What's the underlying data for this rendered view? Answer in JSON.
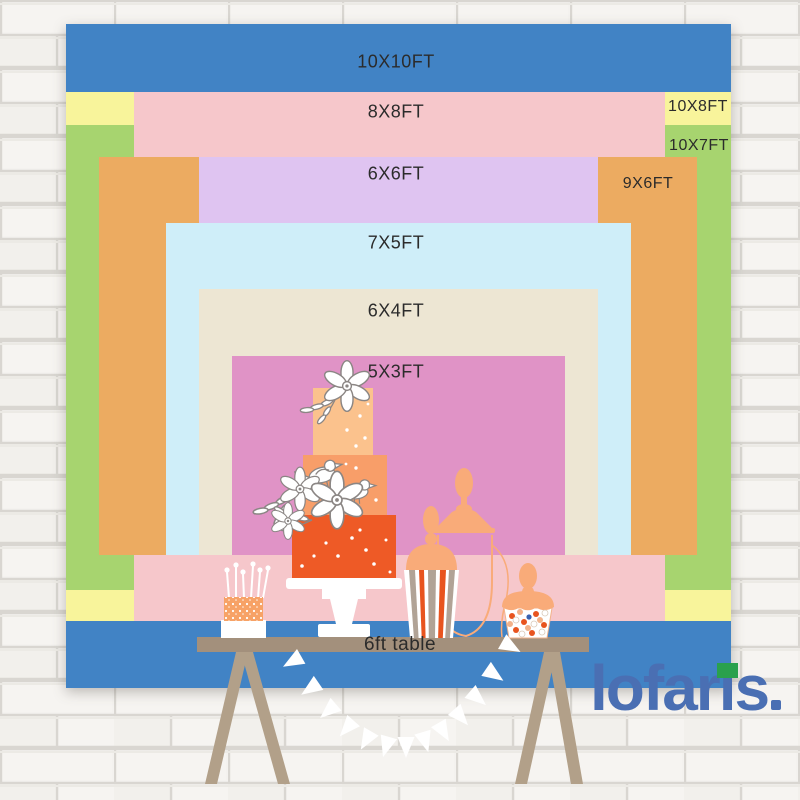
{
  "poster_title": "Backdrop size comparison chart",
  "size_chart": {
    "unit": "FT",
    "items": [
      {
        "label": "10X10FT",
        "width_ft": 10,
        "height_ft": 10,
        "color": "#4183c5",
        "rect": {
          "x": 66,
          "y": 24,
          "w": 665,
          "h": 664
        },
        "label_pos": {
          "x": 396,
          "y": 62
        },
        "label_style": "main"
      },
      {
        "label": "10X8FT",
        "width_ft": 10,
        "height_ft": 8,
        "color": "#f8f49b",
        "rect": {
          "x": 66,
          "y": 92,
          "w": 665,
          "h": 529
        },
        "label_pos": {
          "x": 698,
          "y": 107
        },
        "label_style": "side"
      },
      {
        "label": "10X7FT",
        "width_ft": 10,
        "height_ft": 7,
        "color": "#a7d46f",
        "rect": {
          "x": 66,
          "y": 125,
          "w": 665,
          "h": 465
        },
        "label_pos": {
          "x": 699,
          "y": 146
        },
        "label_style": "side"
      },
      {
        "label": "8X8FT",
        "width_ft": 8,
        "height_ft": 8,
        "color": "#f6c7cb",
        "rect": {
          "x": 134,
          "y": 92,
          "w": 531,
          "h": 529
        },
        "label_pos": {
          "x": 396,
          "y": 112
        },
        "label_style": "main"
      },
      {
        "label": "9X6FT",
        "width_ft": 9,
        "height_ft": 6,
        "color": "#ecab61",
        "rect": {
          "x": 99,
          "y": 157,
          "w": 598,
          "h": 398
        },
        "label_pos": {
          "x": 648,
          "y": 184
        },
        "label_style": "side"
      },
      {
        "label": "6X6FT",
        "width_ft": 6,
        "height_ft": 6,
        "color": "#dfc4f1",
        "rect": {
          "x": 199,
          "y": 157,
          "w": 399,
          "h": 398
        },
        "label_pos": {
          "x": 396,
          "y": 174
        },
        "label_style": "main"
      },
      {
        "label": "7X5FT",
        "width_ft": 7,
        "height_ft": 5,
        "color": "#cfeef9",
        "rect": {
          "x": 166,
          "y": 223,
          "w": 465,
          "h": 332
        },
        "label_pos": {
          "x": 396,
          "y": 243
        },
        "label_style": "main"
      },
      {
        "label": "6X4FT",
        "width_ft": 6,
        "height_ft": 4,
        "color": "#ede6d3",
        "rect": {
          "x": 199,
          "y": 289,
          "w": 399,
          "h": 266
        },
        "label_pos": {
          "x": 396,
          "y": 311
        },
        "label_style": "main"
      },
      {
        "label": "5X3FT",
        "width_ft": 5,
        "height_ft": 3,
        "color": "#e093c6",
        "rect": {
          "x": 232,
          "y": 356,
          "w": 333,
          "h": 199
        },
        "label_pos": {
          "x": 396,
          "y": 372
        },
        "label_style": "main"
      }
    ]
  },
  "table": {
    "label": "6ft table",
    "length_ft": 6
  },
  "brand": {
    "logo_text": "lofaris",
    "logo_color": "#4a6fb3",
    "logo_accent_green": "#2aa14d"
  },
  "scene": {
    "items": [
      "tiered-wedding-cake",
      "mini-cake-with-candles",
      "apothecary-jar",
      "popcorn-favor-box",
      "candy-cup",
      "trestle-table",
      "pennant-banner",
      "brick-wall"
    ],
    "palette": {
      "cake_tier_top": "#fbc28d",
      "cake_tier_middle": "#f89e69",
      "cake_tier_bottom": "#ee5a26",
      "peach_accent": "#f9ab79",
      "stripe_orange": "#e8541f",
      "stripe_taupe": "#b1a396",
      "table_board": "#a3907c",
      "table_legs": "#b2a089",
      "flag_white": "#ffffff",
      "wall_brick": "#f4f2ef",
      "wall_mortar": "#d9d6d1",
      "label_text": "#2b2b2b"
    },
    "banner": {
      "flag_count": 13,
      "x0": 297,
      "x1": 498,
      "y": 649,
      "sag": 88,
      "color": "#ffffff"
    }
  }
}
